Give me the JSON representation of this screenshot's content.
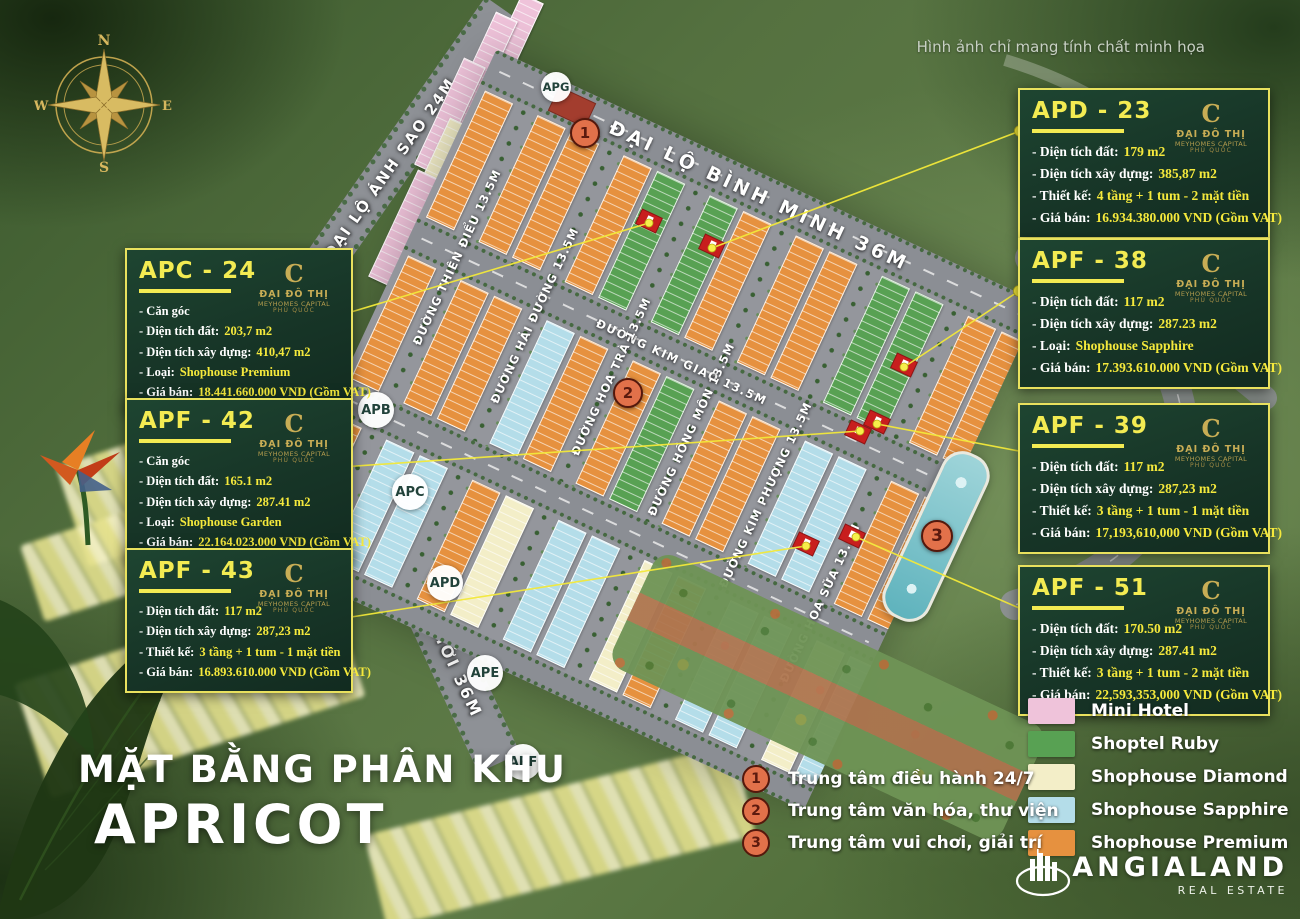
{
  "disclaimer": "Hình ảnh chỉ mang tính chất minh họa",
  "title": {
    "line1": "MẶT BẰNG PHÂN KHU",
    "line2": "APRICOT"
  },
  "compass": {
    "n": "N",
    "e": "E",
    "s": "S",
    "w": "W"
  },
  "roads": {
    "binh_minh": "ĐẠI LỘ BÌNH MINH 36M",
    "anh_sao": "ĐẠI LỘ ÁNH SAO 24M",
    "an_thoi": "ĐẠI LỘ TRUNG TÂM AN THỚI 36M",
    "kim_giao": "ĐƯỜNG KIM GIAO 13.5M",
    "streets": [
      "ĐƯỜNG THIÊN ĐIỂU 13.5M",
      "ĐƯỜNG HẢI ĐƯỜNG 13.5M",
      "ĐƯỜNG HOA TRÀ 13.5M",
      "ĐƯỜNG HỒNG MÔN 13.5M",
      "ĐƯỜNG KIM PHƯỢNG 13.5M",
      "ĐƯỜNG HOA SỮA 13.5M"
    ]
  },
  "zones": [
    "APG",
    "APB",
    "APC",
    "APD",
    "APE",
    "APF"
  ],
  "map_markers": [
    "1",
    "2",
    "3"
  ],
  "marker_legend": [
    {
      "num": "1",
      "label": "Trung tâm điều hành 24/7"
    },
    {
      "num": "2",
      "label": "Trung tâm văn hóa, thư viện"
    },
    {
      "num": "3",
      "label": "Trung tâm vui chơi, giải trí"
    }
  ],
  "legend": [
    {
      "key": "mini",
      "label": "Mini Hotel",
      "color": "#efc3da"
    },
    {
      "key": "ruby",
      "label": "Shoptel Ruby",
      "color": "#58a153"
    },
    {
      "key": "diamond",
      "label": "Shophouse Diamond",
      "color": "#f3eec8"
    },
    {
      "key": "sapphire",
      "label": "Shophouse Sapphire",
      "color": "#b4dde9"
    },
    {
      "key": "premium",
      "label": "Shophouse Premium",
      "color": "#e6913f"
    }
  ],
  "logo": {
    "monogram": "C",
    "line1": "ĐẠI ĐÔ THỊ",
    "line2": "MEYHOMES CAPITAL",
    "line3": "PHÚ QUỐC"
  },
  "brand": {
    "name": "ANGIALAND",
    "tagline": "REAL ESTATE"
  },
  "cards": {
    "left": [
      {
        "id": "APC - 24",
        "lines": [
          {
            "label": "- Căn góc",
            "value": ""
          },
          {
            "label": "- Diện tích đất:",
            "value": "203,7 m2"
          },
          {
            "label": "- Diện tích xây dựng:",
            "value": "410,47 m2"
          },
          {
            "label": "- Loại:",
            "value": "Shophouse Premium"
          },
          {
            "label": "- Giá bán:",
            "value": "18.441.660.000 VND (Gồm VAT)"
          }
        ]
      },
      {
        "id": "APF - 42",
        "lines": [
          {
            "label": "- Căn góc",
            "value": ""
          },
          {
            "label": "- Diện tích đất:",
            "value": "165.1 m2"
          },
          {
            "label": "- Diện tích xây dựng:",
            "value": "287.41 m2"
          },
          {
            "label": "- Loại:",
            "value": "Shophouse Garden"
          },
          {
            "label": "- Giá bán:",
            "value": "22.164.023.000 VND (Gồm VAT)"
          }
        ]
      },
      {
        "id": "APF - 43",
        "lines": [
          {
            "label": "- Diện tích đất:",
            "value": "117 m2"
          },
          {
            "label": "- Diện tích xây dựng:",
            "value": "287,23 m2"
          },
          {
            "label": "- Thiết kế:",
            "value": "3 tầng + 1 tum - 1 mặt tiền"
          },
          {
            "label": "- Giá bán:",
            "value": "16.893.610.000 VND (Gồm VAT)"
          }
        ]
      }
    ],
    "right": [
      {
        "id": "APD - 23",
        "lines": [
          {
            "label": "- Diện tích đất:",
            "value": "179 m2"
          },
          {
            "label": "- Diện tích xây dựng:",
            "value": "385,87 m2"
          },
          {
            "label": "- Thiết kế:",
            "value": "4 tầng + 1 tum - 2 mặt tiền"
          },
          {
            "label": "- Giá bán:",
            "value": "16.934.380.000 VND (Gồm VAT)"
          }
        ]
      },
      {
        "id": "APF - 38",
        "lines": [
          {
            "label": "- Diện tích đất:",
            "value": "117 m2"
          },
          {
            "label": "- Diện tích xây dựng:",
            "value": "287.23 m2"
          },
          {
            "label": "- Loại:",
            "value": "Shophouse Sapphire"
          },
          {
            "label": "- Giá bán:",
            "value": "17.393.610.000 VND (Gồm VAT)"
          }
        ]
      },
      {
        "id": "APF - 39",
        "lines": [
          {
            "label": "- Diện tích đất:",
            "value": "117 m2"
          },
          {
            "label": "- Diện tích xây dựng:",
            "value": "287,23 m2"
          },
          {
            "label": "- Thiết kế:",
            "value": "3 tầng + 1 tum - 1 mặt tiền"
          },
          {
            "label": "- Giá bán:",
            "value": "17,193,610,000 VND (Gồm VAT)"
          }
        ]
      },
      {
        "id": "APF - 51",
        "lines": [
          {
            "label": "- Diện tích đất:",
            "value": "170.50 m2"
          },
          {
            "label": "- Diện tích xây dựng:",
            "value": "287.41 m2"
          },
          {
            "label": "- Thiết kế:",
            "value": "3 tầng + 1 tum - 2 mặt tiền"
          },
          {
            "label": "- Giá bán:",
            "value": "22,593,353,000 VND (Gồm VAT)"
          }
        ]
      }
    ]
  }
}
